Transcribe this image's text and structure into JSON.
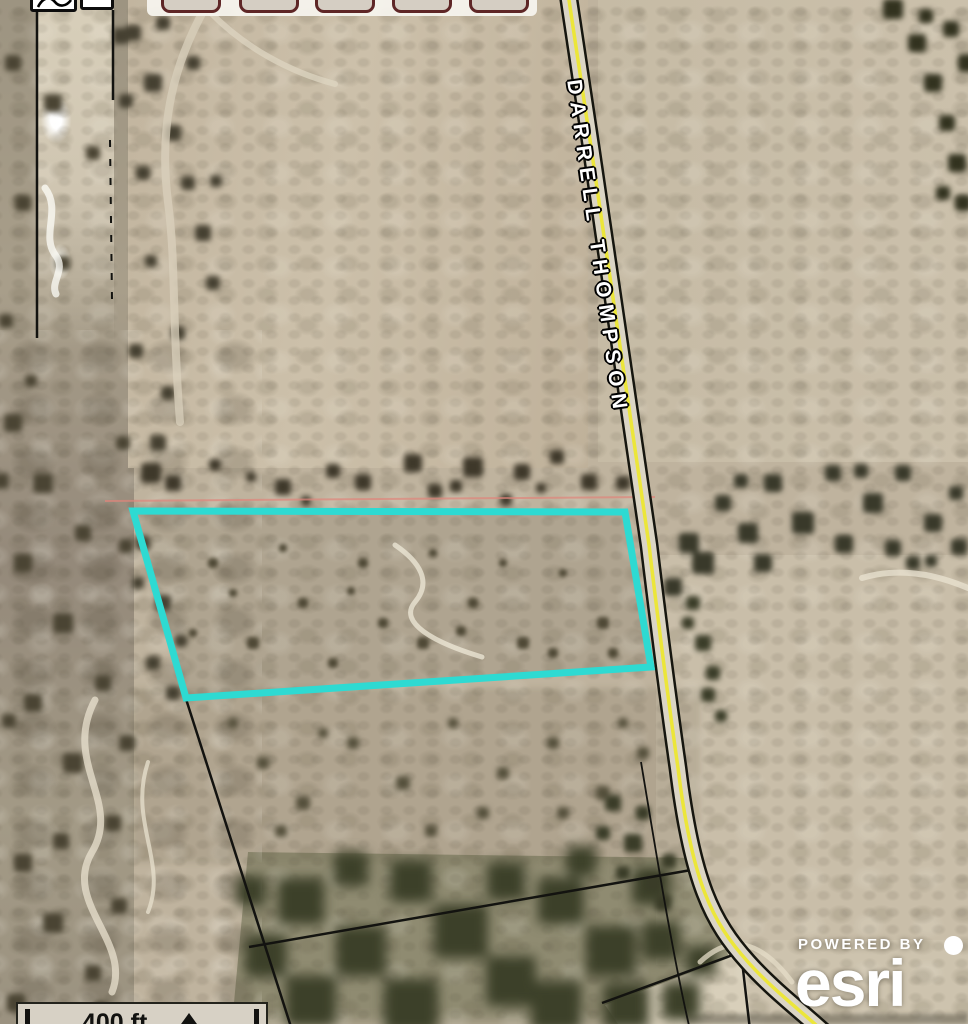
{
  "toolbar": {
    "buttons": [
      {
        "label": ""
      },
      {
        "label": ""
      },
      {
        "label": ""
      },
      {
        "label": ""
      },
      {
        "label": ""
      }
    ]
  },
  "map": {
    "road_label": "DARRELL THOMPSON",
    "colors": {
      "parcel_outline": "#2edad2",
      "road_centerline": "#ece639",
      "road_surface": "#dbd5c5",
      "road_edge": "#16160f",
      "boundary_line": "#131310",
      "survey_line": "#df857b",
      "sand_path": "#efe9d8"
    }
  },
  "scale_bar": {
    "label": "400 ft"
  },
  "attribution": {
    "powered_by": "POWERED BY",
    "brand": "esri"
  }
}
